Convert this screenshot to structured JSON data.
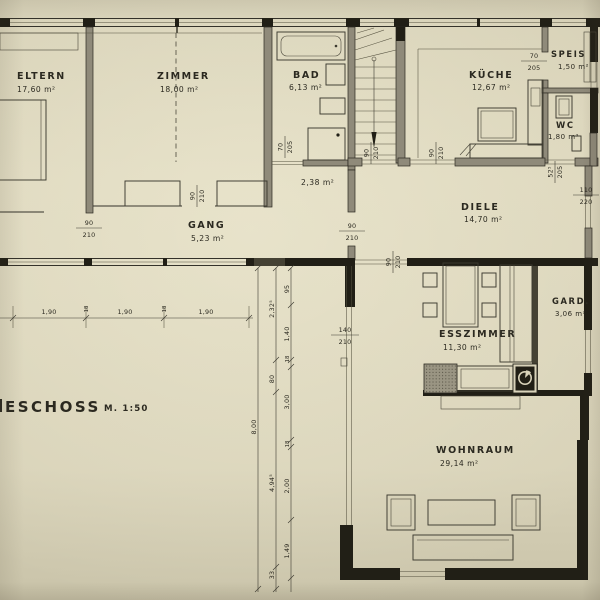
{
  "colors": {
    "paper": "#dad4ba",
    "ink": "#2b2920",
    "wall_fill": "#8f8a7a",
    "wall_dark": "#211f16"
  },
  "title": {
    "text": "ESCHOSS",
    "scale": "M. 1:50"
  },
  "rooms": {
    "eltern": {
      "name": "ELTERN",
      "area": "17,60 m²"
    },
    "zimmer": {
      "name": "ZIMMER",
      "area": "18,00 m²"
    },
    "bad": {
      "name": "BAD",
      "area": "6,13 m²"
    },
    "abstell": {
      "area": "2,38 m²"
    },
    "gang": {
      "name": "GANG",
      "area": "5,23 m²"
    },
    "kueche": {
      "name": "KÜCHE",
      "area": "12,67 m²"
    },
    "speis": {
      "name": "SPEIS",
      "area": "1,50 m²"
    },
    "wc": {
      "name": "WC",
      "area": "1,80 m²"
    },
    "diele": {
      "name": "DIELE",
      "area": "14,70 m²"
    },
    "esszimmer": {
      "name": "ESSZIMMER",
      "area": "11,30 m²"
    },
    "gard": {
      "name": "GARD.",
      "area": "3,06 m²"
    },
    "wohnraum": {
      "name": "WOHNRAUM",
      "area": "29,14 m²"
    }
  },
  "door_dims": {
    "w90": "90",
    "h210": "210",
    "w70": "70",
    "h205": "205",
    "w110": "110",
    "h220": "220",
    "w140": "140",
    "w525": "52⁵"
  },
  "dim_chain": {
    "v95": "95",
    "v2325": "2,32⁵",
    "v140": "1,40",
    "v18": "18",
    "v80": "80",
    "v300": "3,00",
    "v800": "8,00",
    "v4945": "4,94⁵",
    "v200": "2,00",
    "v149": "1,49",
    "v33": "33",
    "h190": "1,90",
    "h18": "18"
  }
}
